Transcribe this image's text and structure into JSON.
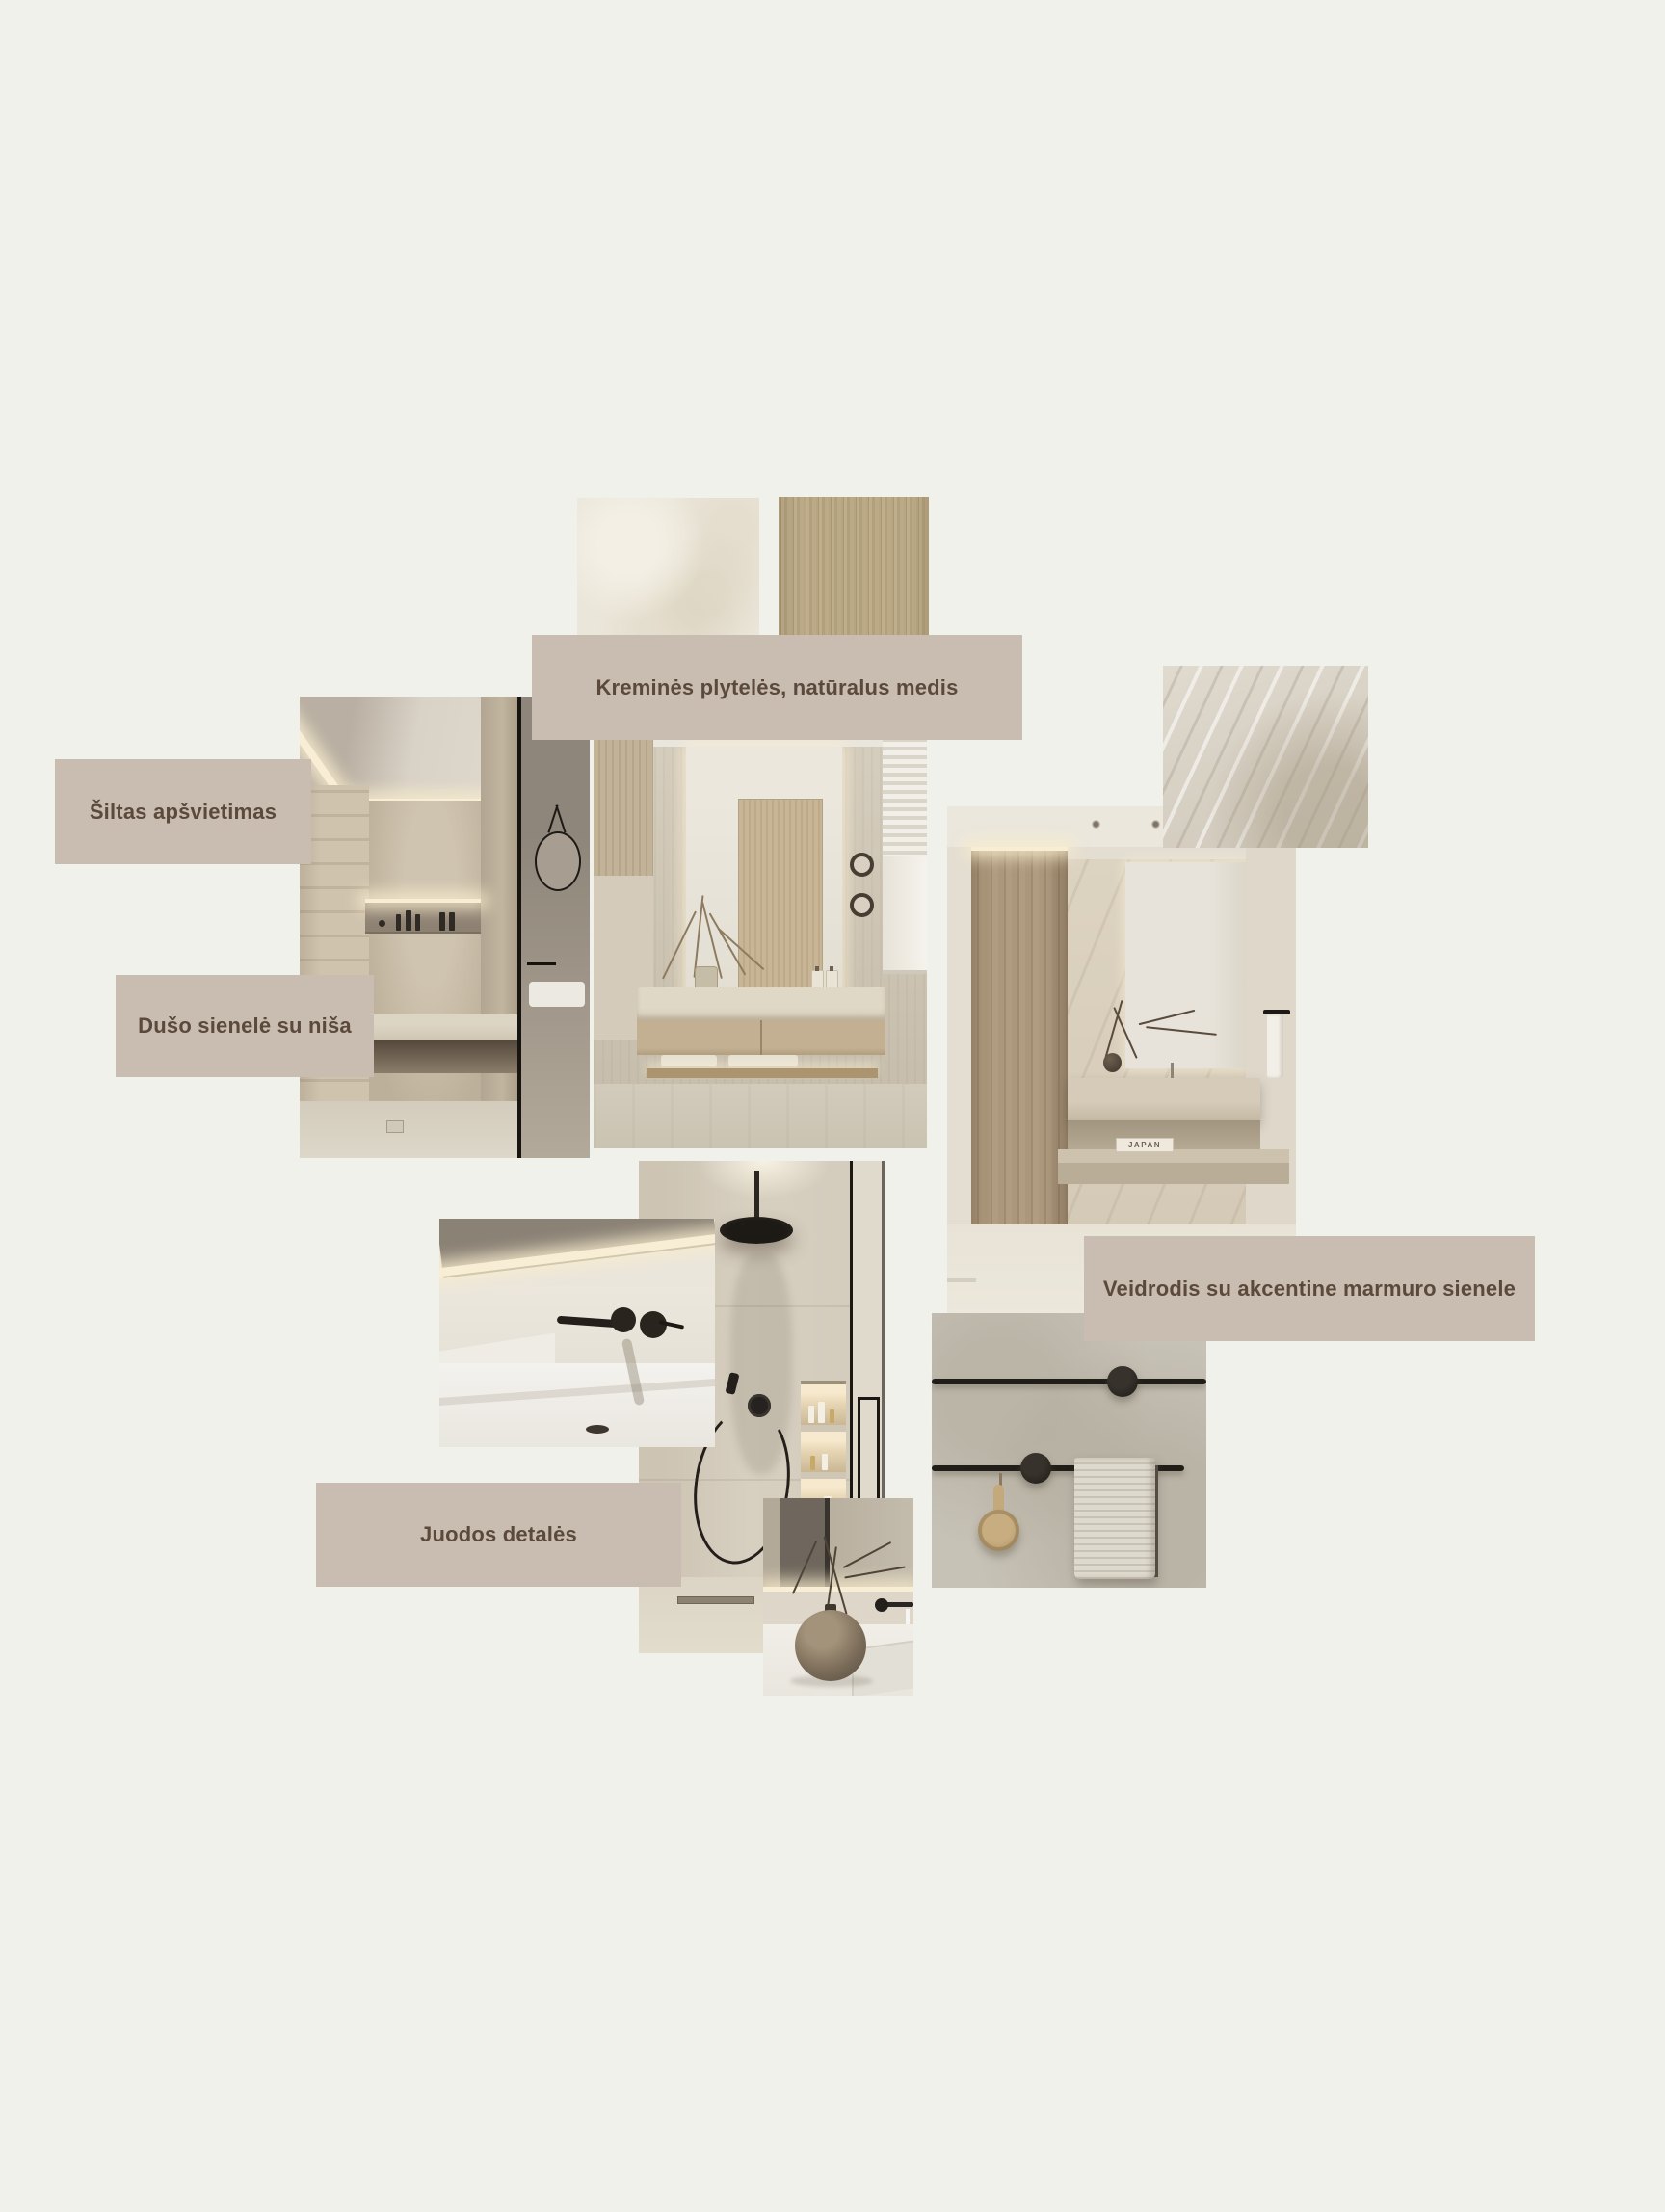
{
  "board": {
    "background_color": "#f0f1ea",
    "label_background": "#c9bcb1",
    "label_text_color": "#5b4a3c",
    "labels": {
      "kremines": "Kreminės plytelės, natūralus medis",
      "siltas": "Šiltas apšvietimas",
      "duso": "Dušo sienelė su niša",
      "veidrodis": "Veidrodis su akcentine marmuro sienele",
      "juodos": "Juodos detalės"
    },
    "photos": {
      "big": {
        "book_title": "JAPAN"
      }
    },
    "palette": {
      "cream_tile": "#ebe6da",
      "light_wood": "#b5a37f",
      "marble": "#d8d2c6",
      "stone_wall": "#cdc4b3",
      "black_fixture": "#211e1a",
      "warm_glow": "#f8eed6"
    }
  }
}
